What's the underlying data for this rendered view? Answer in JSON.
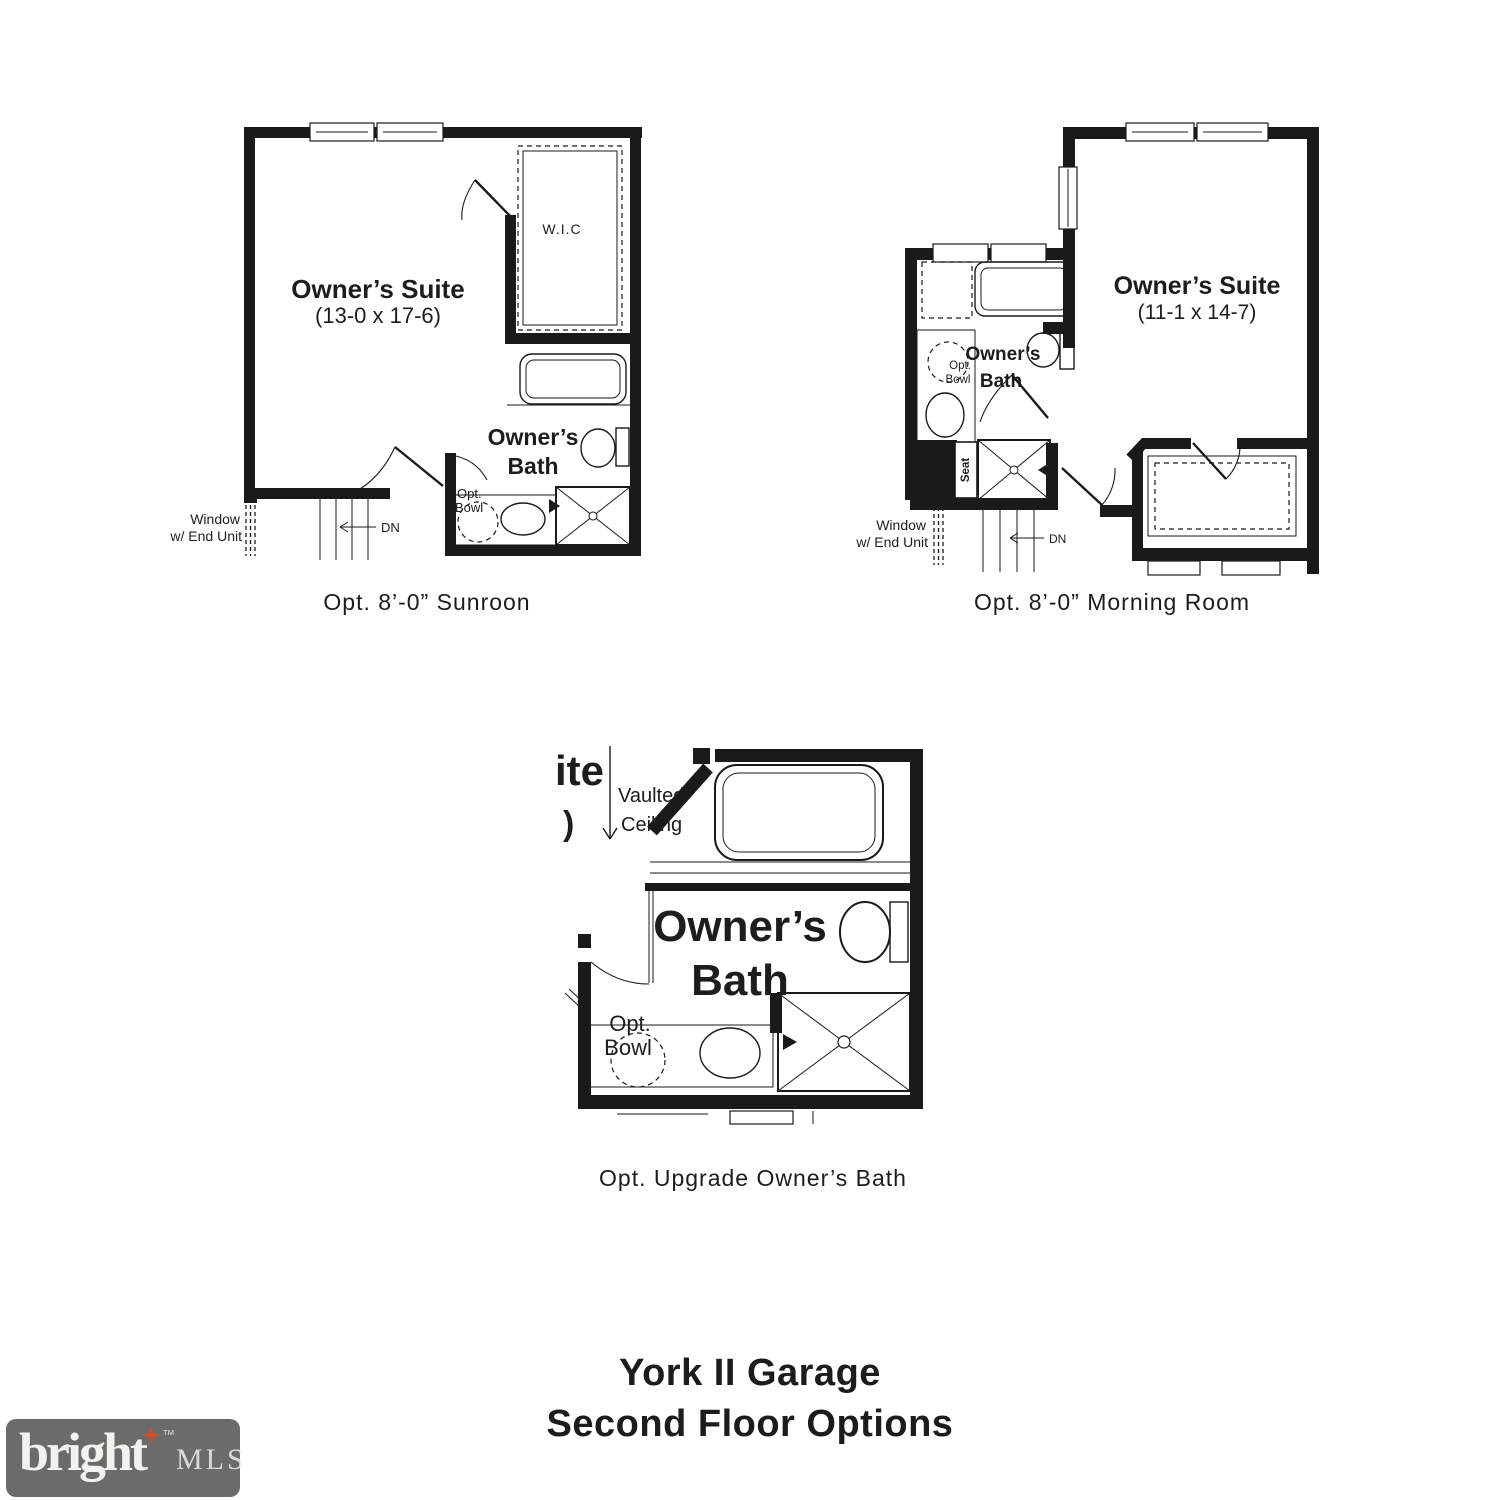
{
  "colors": {
    "ink": "#1a1a1a",
    "text": "#1d1d1d",
    "logo_background": "#6b6b6b",
    "logo_star": "#c8512f",
    "logo_text": "#f4f2ee"
  },
  "plans": {
    "sunroom": {
      "caption": "Opt. 8’-0” Sunroon",
      "room": "Owner’s Suite",
      "dims": "(13-0 x 17-6)",
      "wic": "W.I.C",
      "bath1": "Owner’s",
      "bath2": "Bath",
      "opt": "Opt.",
      "bowl": "Bowl",
      "window1": "Window",
      "window2": "w/ End Unit",
      "dn": "DN"
    },
    "morning_room": {
      "caption": "Opt. 8’-0” Morning Room",
      "room": "Owner’s Suite",
      "dims": "(11-1 x 14-7)",
      "bath1": "Owner’s",
      "bath2": "Bath",
      "opt": "Opt.",
      "bowl": "Bowl",
      "seat": "Seat",
      "window1": "Window",
      "window2": "w/ End Unit",
      "dn": "DN"
    },
    "upgrade_bath": {
      "caption": "Opt. Upgrade Owner’s Bath",
      "cut1": "ite",
      "cut2": ")",
      "vault1": "Vaulted",
      "vault2": "Ceiling",
      "bath1": "Owner’s",
      "bath2": "Bath",
      "opt": "Opt.",
      "bowl": "Bowl"
    }
  },
  "title": {
    "line1": "York II Garage",
    "line2": "Second Floor Options"
  },
  "logo": {
    "brand": "bright",
    "tm": "™",
    "suffix": "MLS"
  }
}
